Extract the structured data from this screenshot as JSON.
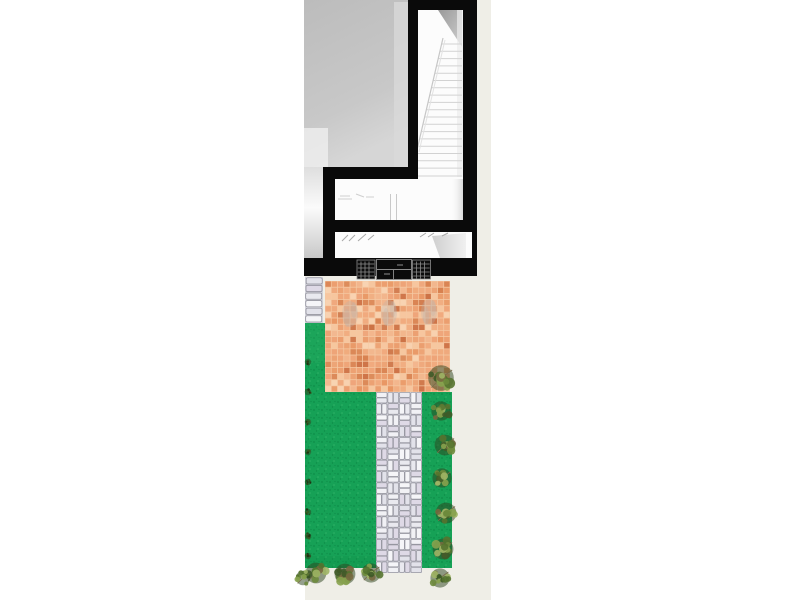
{
  "drawing": {
    "description": "Top-down architectural plan: house interior with gray room, staircase and walled rooms at top; rear garden below with terracotta tile patio, lawn, basketweave paver path and shrub borders",
    "regions": {
      "gray_room": "interior room",
      "staircase": "staircase",
      "upper_room": "interior room",
      "lower_room": "entry room",
      "gate": "rear gate",
      "patio": "terracotta tile patio",
      "lawn": "lawn",
      "path": "paver path",
      "right_lawn": "lawn strip",
      "shrubs": "shrub border"
    },
    "colors": {
      "page_bg": "#ffffff",
      "canvas_bg": "#efeee7",
      "wall": "#0a0a0a",
      "room_white": "#fcfcfc",
      "stair_tread": "#d2d2d2",
      "stair_diag": "#c6c6c6",
      "detail_line": "#a8a8a8",
      "gate_line": "#8d8d8d",
      "tile_grout": "#f5c9a3",
      "tile_palette": [
        "#eea377",
        "#eb9d6e",
        "#f0a97c",
        "#f2b58c",
        "#f6c69e",
        "#e89562",
        "#d8814f",
        "#cc7144",
        "#f8d3b2",
        "#eea377",
        "#eb9d6e",
        "#f0a97c"
      ],
      "smudge": "#b9b4ae",
      "stone_bg": "#cdcdd6",
      "stone_palette": [
        "#f1f1f5",
        "#e9e9ef",
        "#f5f5f8",
        "#e2e2ea",
        "#ded9e6"
      ],
      "stone_edge": "#8e8e98",
      "grass_base": "#16a156",
      "grass_dark": "#0d8c48",
      "grass_light": "#2fb266",
      "shrub_base": "#2c421c",
      "shrub_palette": [
        "#3f5a28",
        "#55732f",
        "#6d8a3c",
        "#87a24e",
        "#9eb465",
        "#77683f"
      ],
      "shrub_mark_palette": [
        "#1e3010",
        "#2f4618",
        "#3c5a20"
      ],
      "twig": "#7b6b49"
    }
  }
}
